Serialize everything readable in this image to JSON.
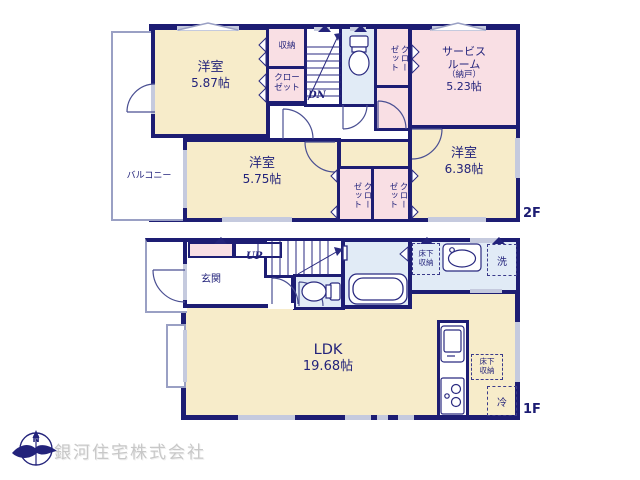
{
  "floor2": {
    "floor_label": "2F",
    "balcony": "バルコニー",
    "bedroom1": {
      "name": "洋室",
      "area": "5.87帖"
    },
    "bedroom2": {
      "name": "洋室",
      "area": "5.75帖"
    },
    "bedroom3": {
      "name": "洋室",
      "area": "6.38帖"
    },
    "service_room": {
      "name_line1": "サービス",
      "name_line2": "ルーム",
      "name_line3": "（納戸）",
      "area": "5.23帖"
    },
    "storage": "収納",
    "hall_closet": {
      "line1": "クロー",
      "line2": "ゼット"
    },
    "service_closet": {
      "line1": "クロー",
      "line2": "ゼット"
    },
    "closet_left": {
      "line1": "クロー",
      "line2": "ゼット"
    },
    "closet_right": {
      "line1": "クロー",
      "line2": "ゼット"
    },
    "stairs_down": "DN"
  },
  "floor1": {
    "floor_label": "1F",
    "entrance": "玄関",
    "stairs_up": "UP",
    "ldk": {
      "name": "LDK",
      "area": "19.68帖"
    },
    "washer": "洗",
    "fridge": "冷",
    "underfloor_storage_washroom": {
      "line1": "床下",
      "line2": "収納"
    },
    "underfloor_storage_kitchen": {
      "line1": "床下",
      "line2": "収納"
    }
  },
  "footer": {
    "company": "銀河住宅株式会社",
    "compass_north": "N"
  },
  "colors": {
    "wall": "#1d1d73",
    "room_floor": "#f7ecca",
    "closet_floor": "#f9dfe4",
    "wet_floor": "#e1ebf6",
    "window": "#c5cade",
    "watermark": "#c8c8c8"
  }
}
